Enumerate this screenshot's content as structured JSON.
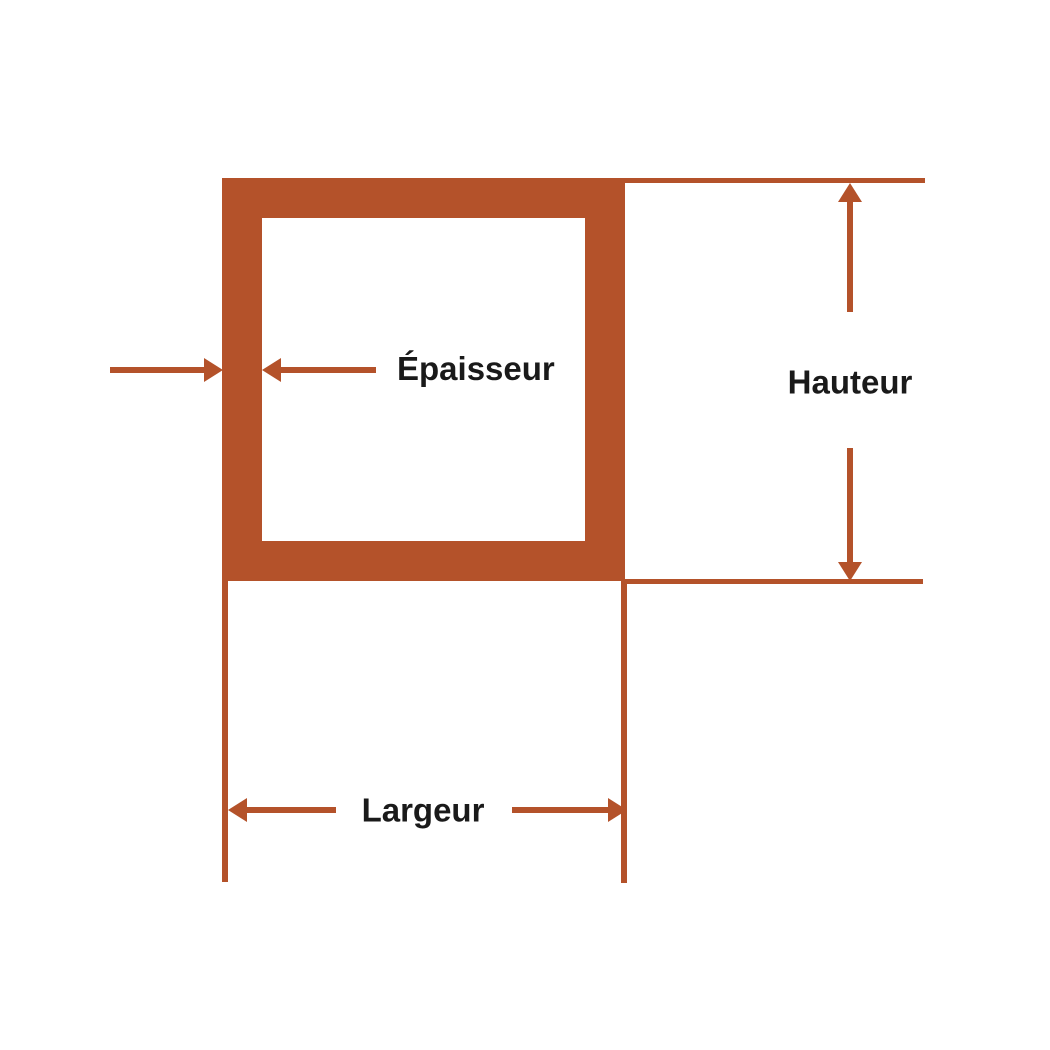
{
  "diagram": {
    "type": "square-tube-cross-section",
    "labels": {
      "thickness": "Épaisseur",
      "height": "Hauteur",
      "width": "Largeur"
    },
    "colors": {
      "accent": "#B4522A",
      "text": "#1A1A1A",
      "bg": "#FFFFFF"
    }
  }
}
